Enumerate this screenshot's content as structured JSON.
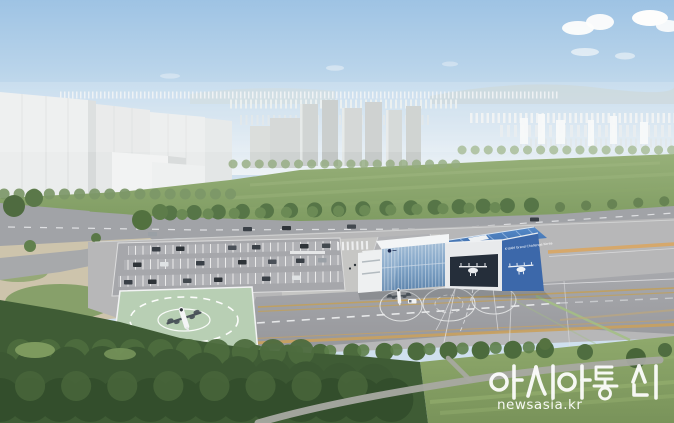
{
  "scene": {
    "type": "aerial architectural rendering",
    "subject": "UAM vertiport test facility with glass terminal, blue hangar, helipad, parking lot and apron in front of a city skyline"
  },
  "building": {
    "sign_text": "K-UAM Grand Challenge Korea",
    "sign_color": "#ffffff"
  },
  "watermark": {
    "agency": "아시아통신",
    "website": "newsasia.kr",
    "color": "#ffffff"
  },
  "colors": {
    "sky_top": "#9ec3e4",
    "sky_horizon": "#eef3f6",
    "field_green": "#8aa66d",
    "helipad_green": "#b8cfb4",
    "apron_gray": "#9fa0a4",
    "road_gray": "#a1a3a7",
    "dirt_tan": "#cdc4ac",
    "hangar_blue": "#3c68aa",
    "roof_blue": "#4a7cbd",
    "glass_blue": "#7fa3c8",
    "tree_dark_green": "#3f5c35",
    "taxi_line_yellow": "#c9a15e",
    "marking_white": "#eeeff1"
  }
}
